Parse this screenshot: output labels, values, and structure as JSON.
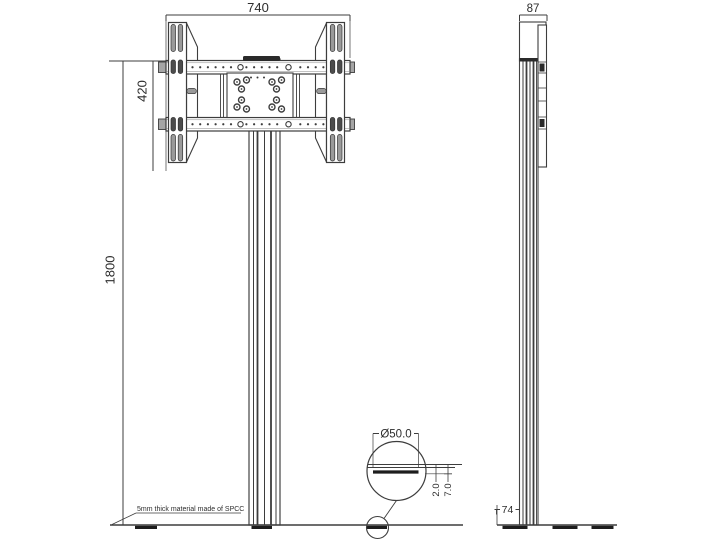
{
  "drawing": {
    "type": "technical-drawing",
    "subject": "TV floor stand - front and side elevations with base foot detail",
    "views": {
      "front": {
        "dim_width": "740",
        "dim_bracket_height": "420",
        "dim_total_height": "1800",
        "material_note": "5mm thick material made of SPCC"
      },
      "side": {
        "dim_depth": "87",
        "dim_base_offset": "74"
      },
      "detail": {
        "dim_foot_diameter": "Ø50.0",
        "dim_plate_thickness": "2.0",
        "dim_foot_height": "7.0"
      }
    },
    "colors": {
      "line": "#3d3d3d",
      "dark_fill": "#262626",
      "gray_fill": "#9a9a9a",
      "background": "#ffffff"
    }
  }
}
